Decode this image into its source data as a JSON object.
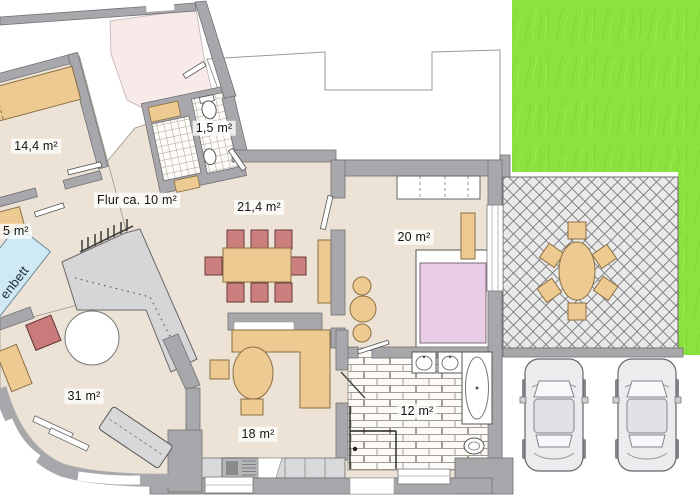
{
  "title": "Floor plan",
  "labels": {
    "room_14_4": "14,4 m²",
    "wc_1_5": "1,5 m²",
    "flur": "Flur ca. 10 m²",
    "room_21_4": "21,4 m²",
    "room_20": "20 m²",
    "room_31": "31 m²",
    "room_18": "18 m²",
    "bath_12": "12 m²",
    "room_5_partial": "5 m²",
    "bed_partial": "enbett"
  },
  "colors": {
    "wall": "#a8a8ac",
    "floor": "#ece3d6",
    "pink_room": "#f9eaea",
    "furniture_tan": "#edca92",
    "chair_red": "#cb7f7f",
    "bed_pink": "#e9cce6",
    "bunk_bed_blue": "#cfe9f5",
    "lawn_green": "#8ce33f",
    "patio_tile": "#e9e9ea",
    "stairs": "#d6d6d9"
  }
}
